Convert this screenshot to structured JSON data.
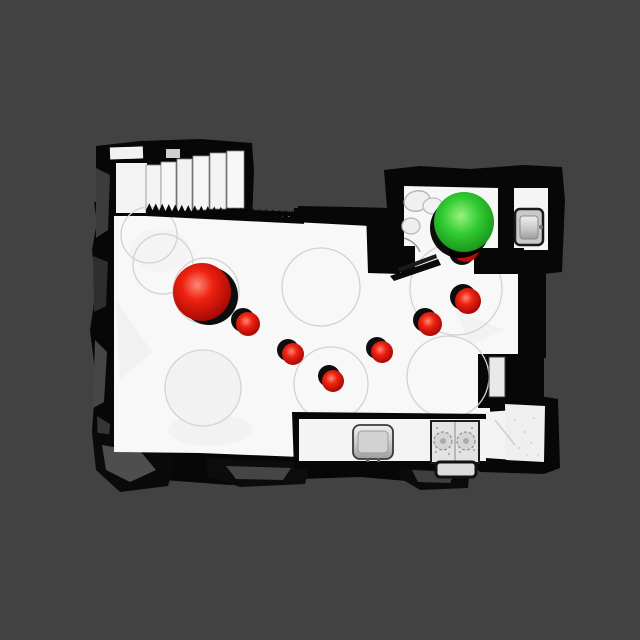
{
  "scene": {
    "type": "3d-mesh-top-down-view",
    "background_color": "#424242",
    "floor_color": "#f8f8f8",
    "wall_color": "#070707",
    "sphere_colors": {
      "red": "#e01515",
      "green": "#2fca2f"
    },
    "spheres": [
      {
        "name": "sphere-red-large",
        "color": "red",
        "cx": 202,
        "cy": 292,
        "r": 29,
        "sdx": 7,
        "sdy": 4
      },
      {
        "name": "sphere-red-hidden-under-green",
        "color": "red",
        "cx": 466,
        "cy": 249,
        "r": 13,
        "sdx": -4,
        "sdy": 3
      },
      {
        "name": "sphere-green",
        "color": "green",
        "cx": 464,
        "cy": 222,
        "r": 30,
        "sdx": -4,
        "sdy": 6
      },
      {
        "name": "sphere-red-1",
        "color": "red",
        "cx": 248,
        "cy": 324,
        "r": 12,
        "sdx": -5,
        "sdy": -4
      },
      {
        "name": "sphere-red-2",
        "color": "red",
        "cx": 293,
        "cy": 354,
        "r": 11,
        "sdx": -5,
        "sdy": -4
      },
      {
        "name": "sphere-red-3",
        "color": "red",
        "cx": 333,
        "cy": 381,
        "r": 11,
        "sdx": -4,
        "sdy": -5
      },
      {
        "name": "sphere-red-4",
        "color": "red",
        "cx": 382,
        "cy": 352,
        "r": 11,
        "sdx": -5,
        "sdy": -4
      },
      {
        "name": "sphere-red-5",
        "color": "red",
        "cx": 430,
        "cy": 324,
        "r": 12,
        "sdx": -5,
        "sdy": -4
      },
      {
        "name": "sphere-red-6",
        "color": "red",
        "cx": 468,
        "cy": 301,
        "r": 13,
        "sdx": -5,
        "sdy": -4
      }
    ],
    "floor_circles": [
      {
        "cx": 206,
        "cy": 291,
        "r": 33
      },
      {
        "cx": 203,
        "cy": 388,
        "r": 38
      },
      {
        "cx": 149,
        "cy": 235,
        "r": 28
      },
      {
        "cx": 163,
        "cy": 264,
        "r": 30
      },
      {
        "cx": 321,
        "cy": 287,
        "r": 39
      },
      {
        "cx": 331,
        "cy": 384,
        "r": 37
      },
      {
        "cx": 456,
        "cy": 289,
        "r": 46
      },
      {
        "cx": 448,
        "cy": 377,
        "r": 41
      }
    ],
    "railing": {
      "x1": 146,
      "x2": 304,
      "tooth_w": 6.5,
      "tooth_h": 7,
      "slope": 0.05,
      "band_h": 13,
      "y_top": 203
    },
    "rooms": [
      "main-room",
      "bathroom",
      "staircase",
      "alcove"
    ],
    "objects": [
      "staircase",
      "serrated-railing",
      "kitchen-counter",
      "counter-sink",
      "counter-stove",
      "bathroom-sink",
      "bathroom-fixtures",
      "wall-niche",
      "open-door"
    ]
  }
}
